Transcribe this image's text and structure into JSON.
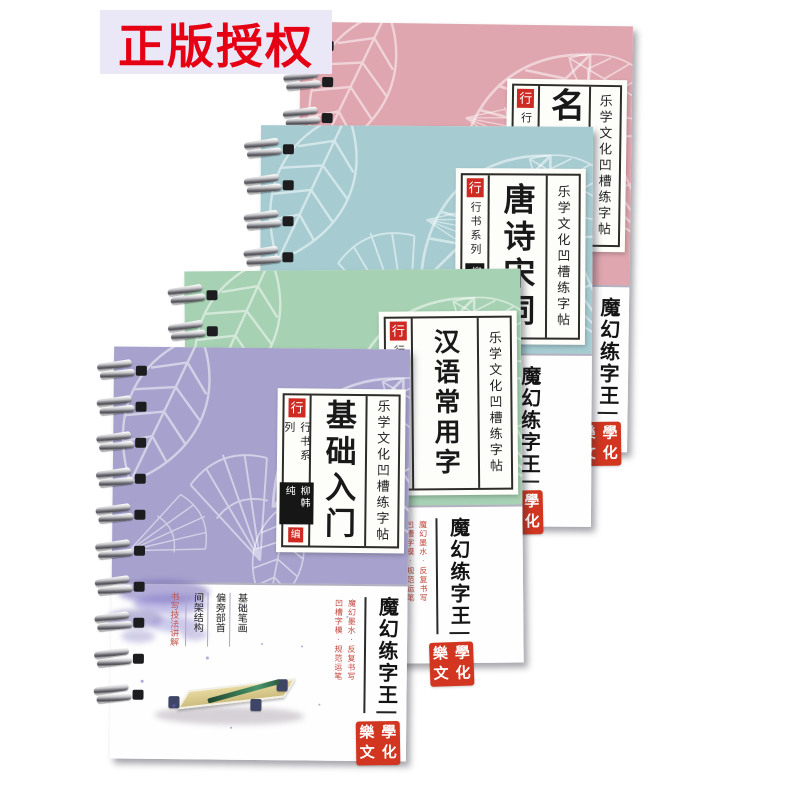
{
  "badge": {
    "text": "正版授权",
    "bg_color": "#eae7f7",
    "text_color": "#e60014"
  },
  "brand": {
    "series_tag": "行",
    "series_name": "行书系列",
    "author": "柳韩纯",
    "author_role": "编",
    "tagline": "乐学文化凹槽练字帖",
    "product_name": "魔幻练字王",
    "slogan_right": "魔幻墨水·反复书写",
    "slogan_left": "凹槽字模·规范运笔",
    "seal_chars": [
      "樂",
      "學",
      "文",
      "化"
    ],
    "seal_color": "#d23620",
    "tag_color": "#ce2a23"
  },
  "books": [
    {
      "title": "名家散文",
      "cover_color": "#e0a6af"
    },
    {
      "title": "唐诗宋词",
      "cover_color": "#a6ccd2"
    },
    {
      "title": "汉语常用字",
      "cover_color": "#a6d1b2"
    },
    {
      "title": "基础入门",
      "cover_color": "#a6a2cd",
      "contents_columns": [
        "基础笔画",
        "偏旁部首",
        "间架结构"
      ],
      "contents_highlight": "书写技法讲解",
      "has_illustration": true
    }
  ]
}
